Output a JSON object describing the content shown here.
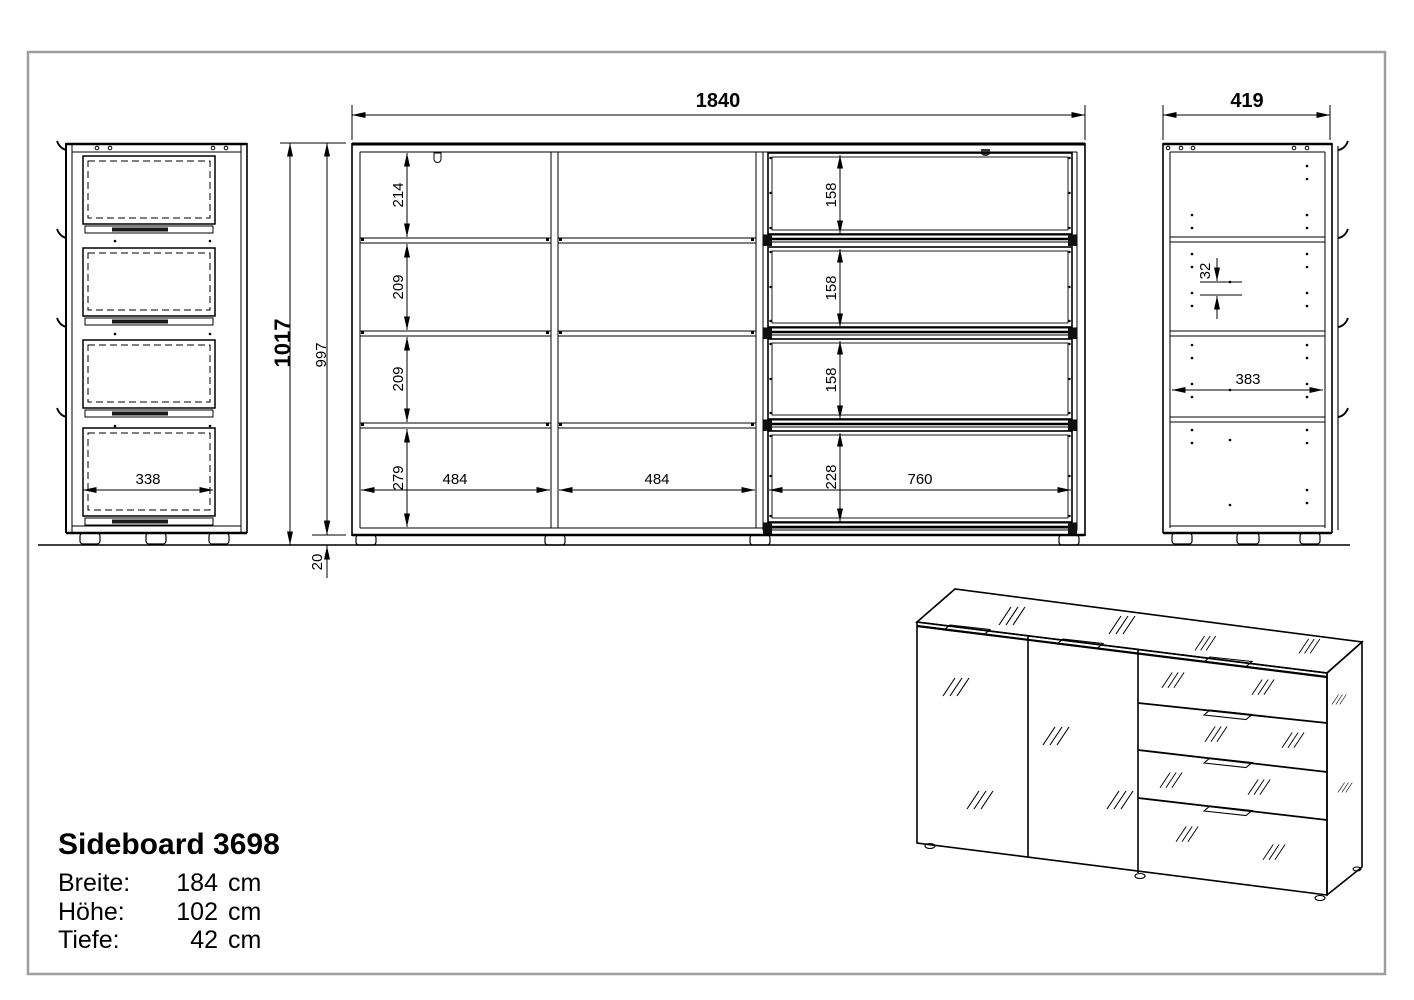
{
  "title_block": {
    "title": "Sideboard 3698",
    "rows": [
      {
        "label": "Breite:",
        "value": "184",
        "unit": "cm"
      },
      {
        "label": "Höhe:",
        "value": "102",
        "unit": "cm"
      },
      {
        "label": "Tiefe:",
        "value": "42",
        "unit": "cm"
      }
    ]
  },
  "dimensions": {
    "front_view": {
      "width": "1840",
      "row_heights": [
        "214",
        "209",
        "209",
        "279"
      ],
      "drawer_heights": [
        "158",
        "158",
        "158",
        "228"
      ],
      "compartment_widths": [
        "484",
        "484"
      ],
      "drawer_width": "760"
    },
    "heights": {
      "total": "1017",
      "body": "997",
      "plinth": "20"
    },
    "left_view": {
      "drawer_depth": "338"
    },
    "right_view": {
      "depth": "419",
      "shelf_depth": "383",
      "hole_spacing": "32"
    }
  },
  "colors": {
    "line": "#000000",
    "frame": "#9e9e9e",
    "background": "#ffffff"
  }
}
